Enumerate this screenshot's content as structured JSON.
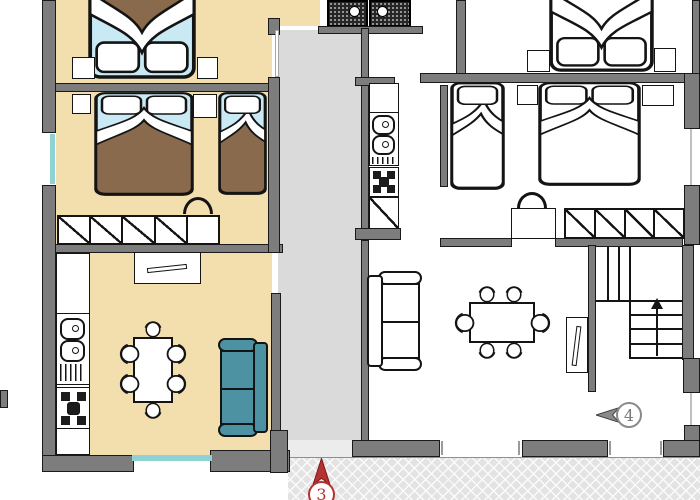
{
  "floorplan": {
    "type": "apartment-floor-plan",
    "units": [
      {
        "marker_label": "3",
        "marker_color": "#b43232",
        "arrow_direction": "up"
      },
      {
        "marker_label": "4",
        "marker_color": "#8a8a8a",
        "arrow_direction": "left"
      }
    ],
    "stairs": {
      "arrow_direction": "up"
    },
    "palette": {
      "wall": "#7d7d7d",
      "left_apartment_floor": "#f2dfad",
      "corridor_floor": "#dadada",
      "terrace_hatch": "#e3e3e3",
      "sofa_teal": "#4d92a2",
      "bed_sheet_blue": "#c9e9f4",
      "bed_blanket_brown": "#8a6a4c",
      "window_glass": "#8ed2d6",
      "shower_tray": "#262626"
    }
  }
}
